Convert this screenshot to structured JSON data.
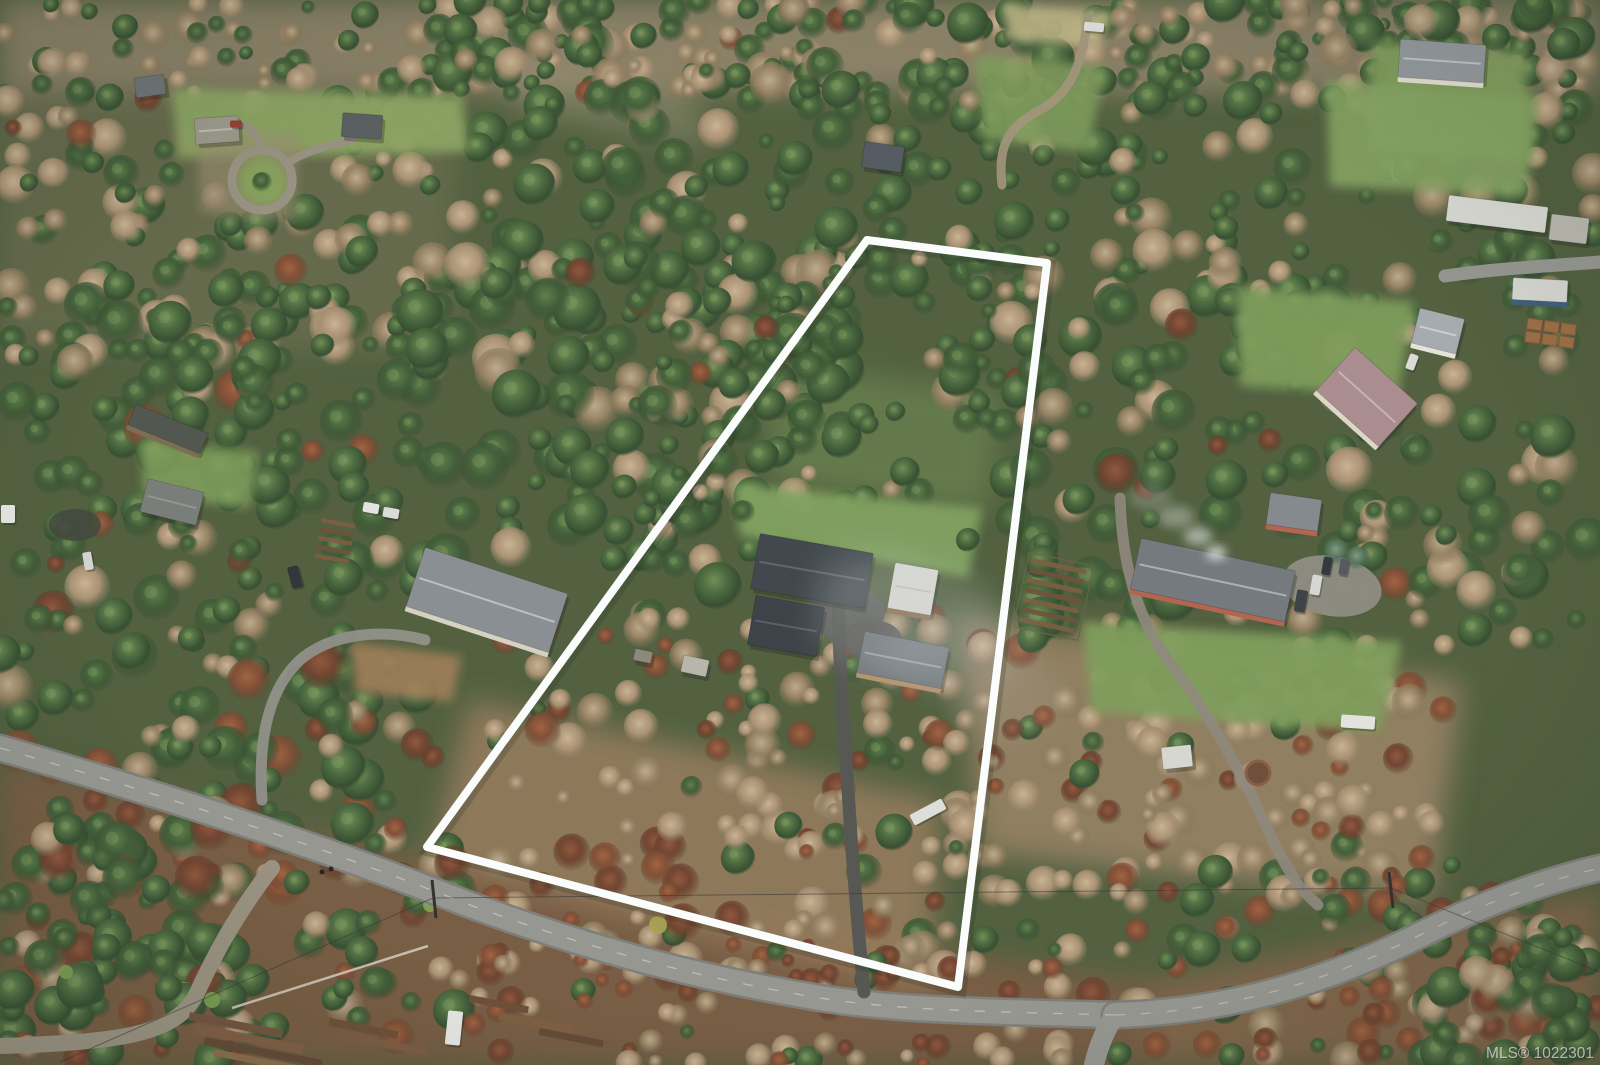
{
  "watermark": {
    "text": "MLS® 1022301"
  },
  "property_boundary": {
    "color": "#ffffff",
    "points": "867,240 1047,263 958,987 427,847",
    "stroke_width": 8
  },
  "scene": {
    "type": "aerial-drone-photo",
    "setting": "rural forested acreage in winter",
    "features": [
      "outlined flag-shaped lot with two houses, white-roof garage and long dark driveway",
      "neighboring homes with gardens, greenhouses and outbuildings",
      "country road curving along the lower edge with side lanes",
      "mixed conifer and bare deciduous forest",
      "russet winter brush and lumber stacks near the road",
      "woodsmoke plume from red farmhouse chimney"
    ]
  },
  "palette": {
    "conifer_green": "#3d5a33",
    "bare_deciduous_tan": "#a98f6f",
    "winter_brush_russet": "#7f4a30",
    "grass_green": "#80a05c",
    "road_gray": "#95958f",
    "road_edge_gray": "#7c7c76",
    "asphalt_dark": "#53534f",
    "gravel_tan": "#99907e",
    "boundary_white": "#ffffff",
    "haze_white": "#cfd4d6"
  }
}
